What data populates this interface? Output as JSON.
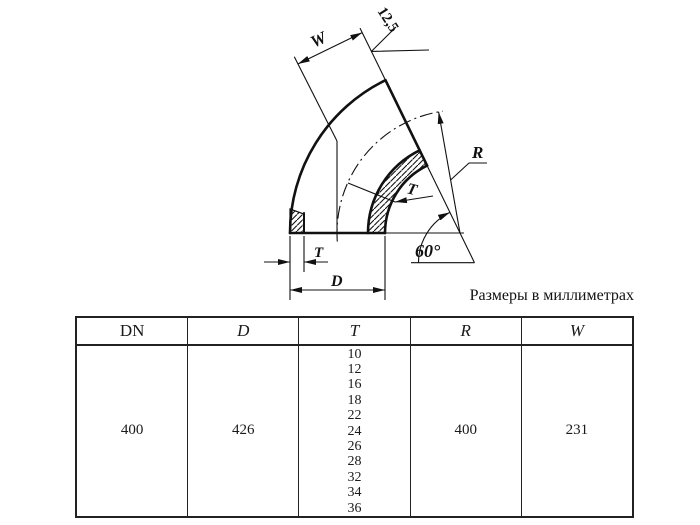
{
  "drawing": {
    "labels": {
      "w": "W",
      "roughness": "12,5",
      "radius": "R",
      "wall_upper": "T",
      "angle": "60°",
      "wall_lower": "T",
      "diameter": "D"
    }
  },
  "caption": "Размеры в миллиметрах",
  "table": {
    "headers": [
      "DN",
      "D",
      "T",
      "R",
      "W"
    ],
    "row": {
      "dn": "400",
      "d": "426",
      "t_values": [
        "10",
        "12",
        "16",
        "18",
        "22",
        "24",
        "26",
        "28",
        "32",
        "34",
        "36"
      ],
      "r": "400",
      "w": "231"
    }
  }
}
